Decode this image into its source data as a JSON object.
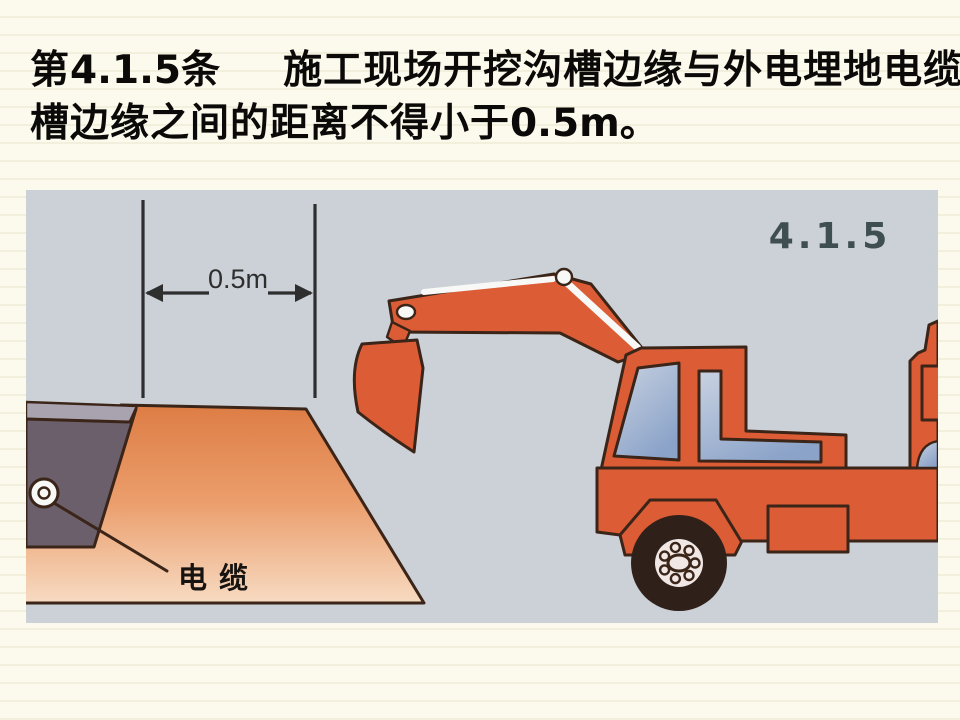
{
  "slide": {
    "title": {
      "clause_prefix": "第",
      "clause_number": "4.1.5",
      "clause_suffix": "条",
      "line1_text": "施工现场开挖沟槽边缘与外电埋地电缆沟",
      "line2_text": "槽边缘之间的距离不得小于",
      "line2_number": "0.5m",
      "line2_period": "。"
    }
  },
  "figure": {
    "corner_label": "4.1.5",
    "dimension_label": "0.5m",
    "cable_label": "电缆",
    "colors": {
      "page_bg": "#fcfaed",
      "page_stripe": "#f3efdd",
      "title_color": "#0c0a09",
      "figure_bg": "#cbd1d7",
      "soil_top": "#dd7b43",
      "soil_mid": "#eb9e6c",
      "soil_bottom": "#f7dcc4",
      "trench_fill": "#6a5f6b",
      "surface_lip": "#a9a2af",
      "excavator_red": "#dc5c36",
      "outline_dark": "#3b2418",
      "window_light": "#c9d2e1",
      "window_blue": "#8ba3c9",
      "tire_dark": "#30201a",
      "hub_light": "#f1e7e4",
      "cylinder_white": "#f8f8f6",
      "dimension_color": "#2e2e2e",
      "figure_number_color": "#3f4e50",
      "label_color": "#171310"
    }
  }
}
